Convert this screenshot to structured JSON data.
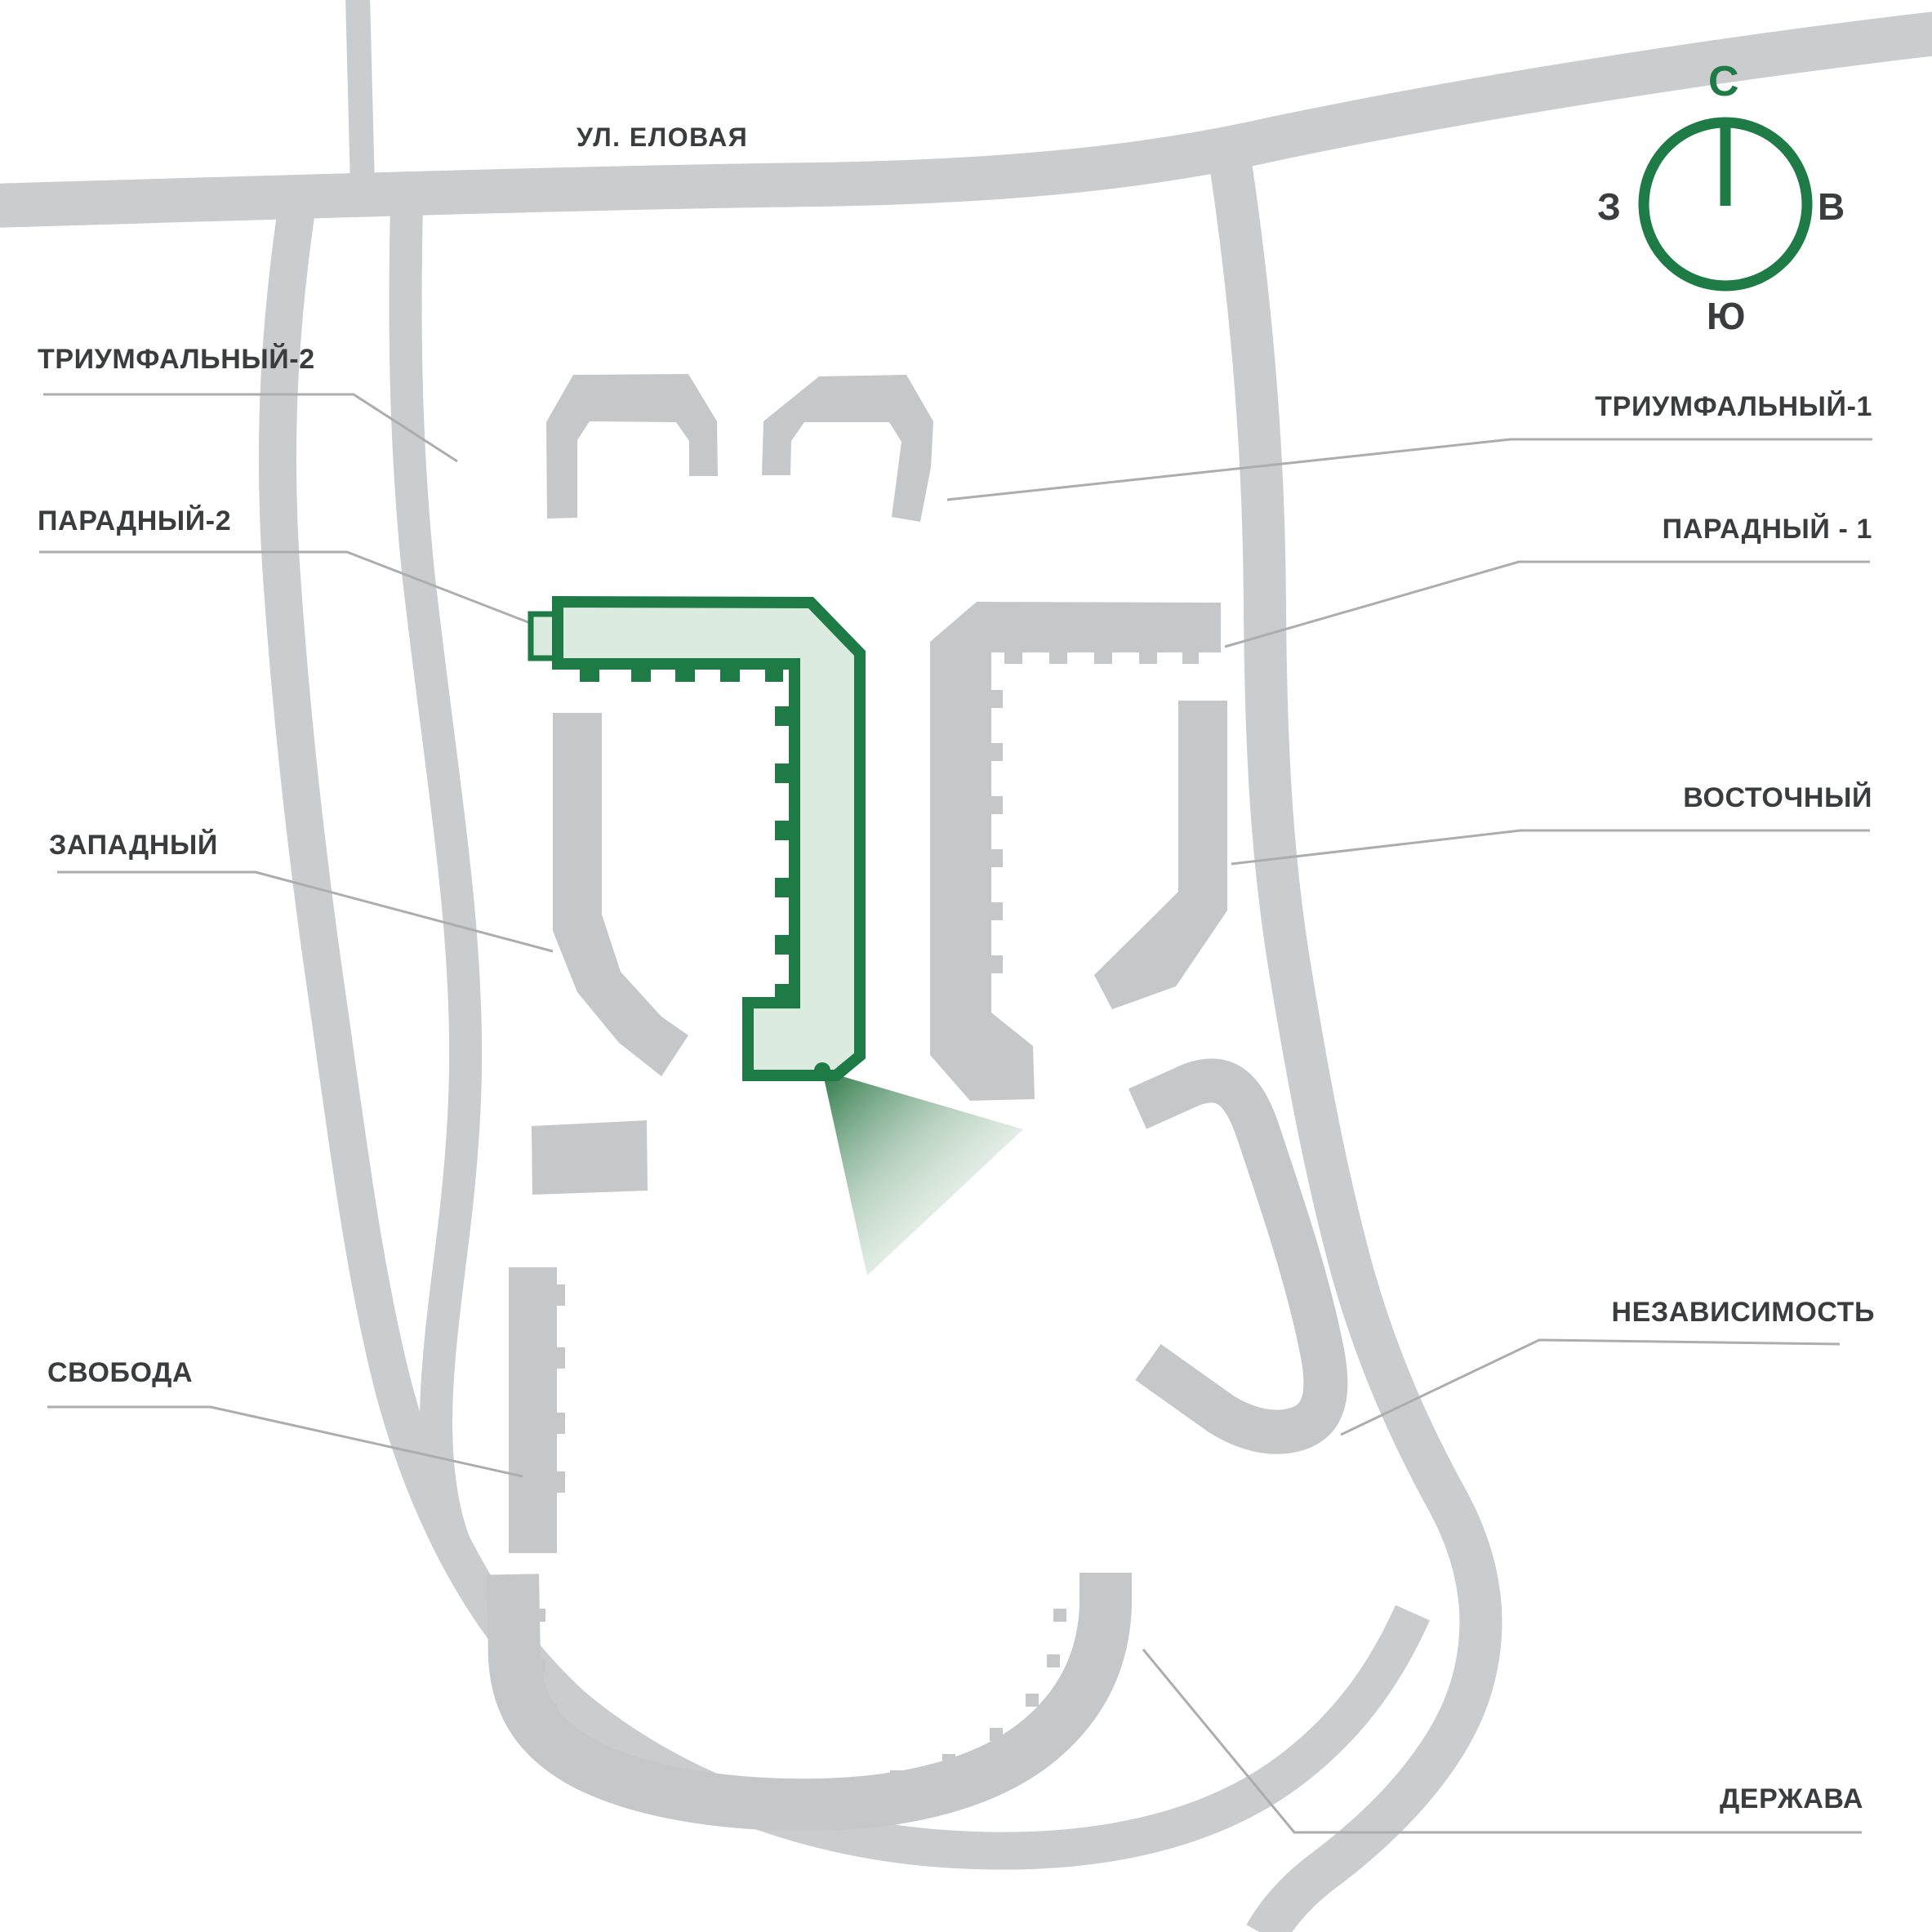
{
  "street": {
    "label": "УЛ. ЕЛОВАЯ"
  },
  "compass": {
    "north": "С",
    "west": "З",
    "east": "В",
    "south": "Ю"
  },
  "selected_building": "ПАРАДНЫЙ-2",
  "labels": {
    "triumfalny2": "ТРИУМФАЛЬНЫЙ-2",
    "paradny2": "ПАРАДНЫЙ-2",
    "zapadny": "ЗАПАДНЫЙ",
    "svoboda": "СВОБОДА",
    "triumfalny1": "ТРИУМФАЛЬНЫЙ-1",
    "paradny1": "ПАРАДНЫЙ - 1",
    "vostochny": "ВОСТОЧНЫЙ",
    "nezavisimost": "НЕЗАВИСИМОСТЬ",
    "derzhava": "ДЕРЖАВА"
  },
  "colors": {
    "road": "#cacccd",
    "building": "#c5c7c8",
    "accent": "#1e7b45",
    "accent_fill": "#dcebdf",
    "label_text": "#3a3c3e",
    "leader_line": "#abadaf",
    "background": "#ffffff"
  }
}
